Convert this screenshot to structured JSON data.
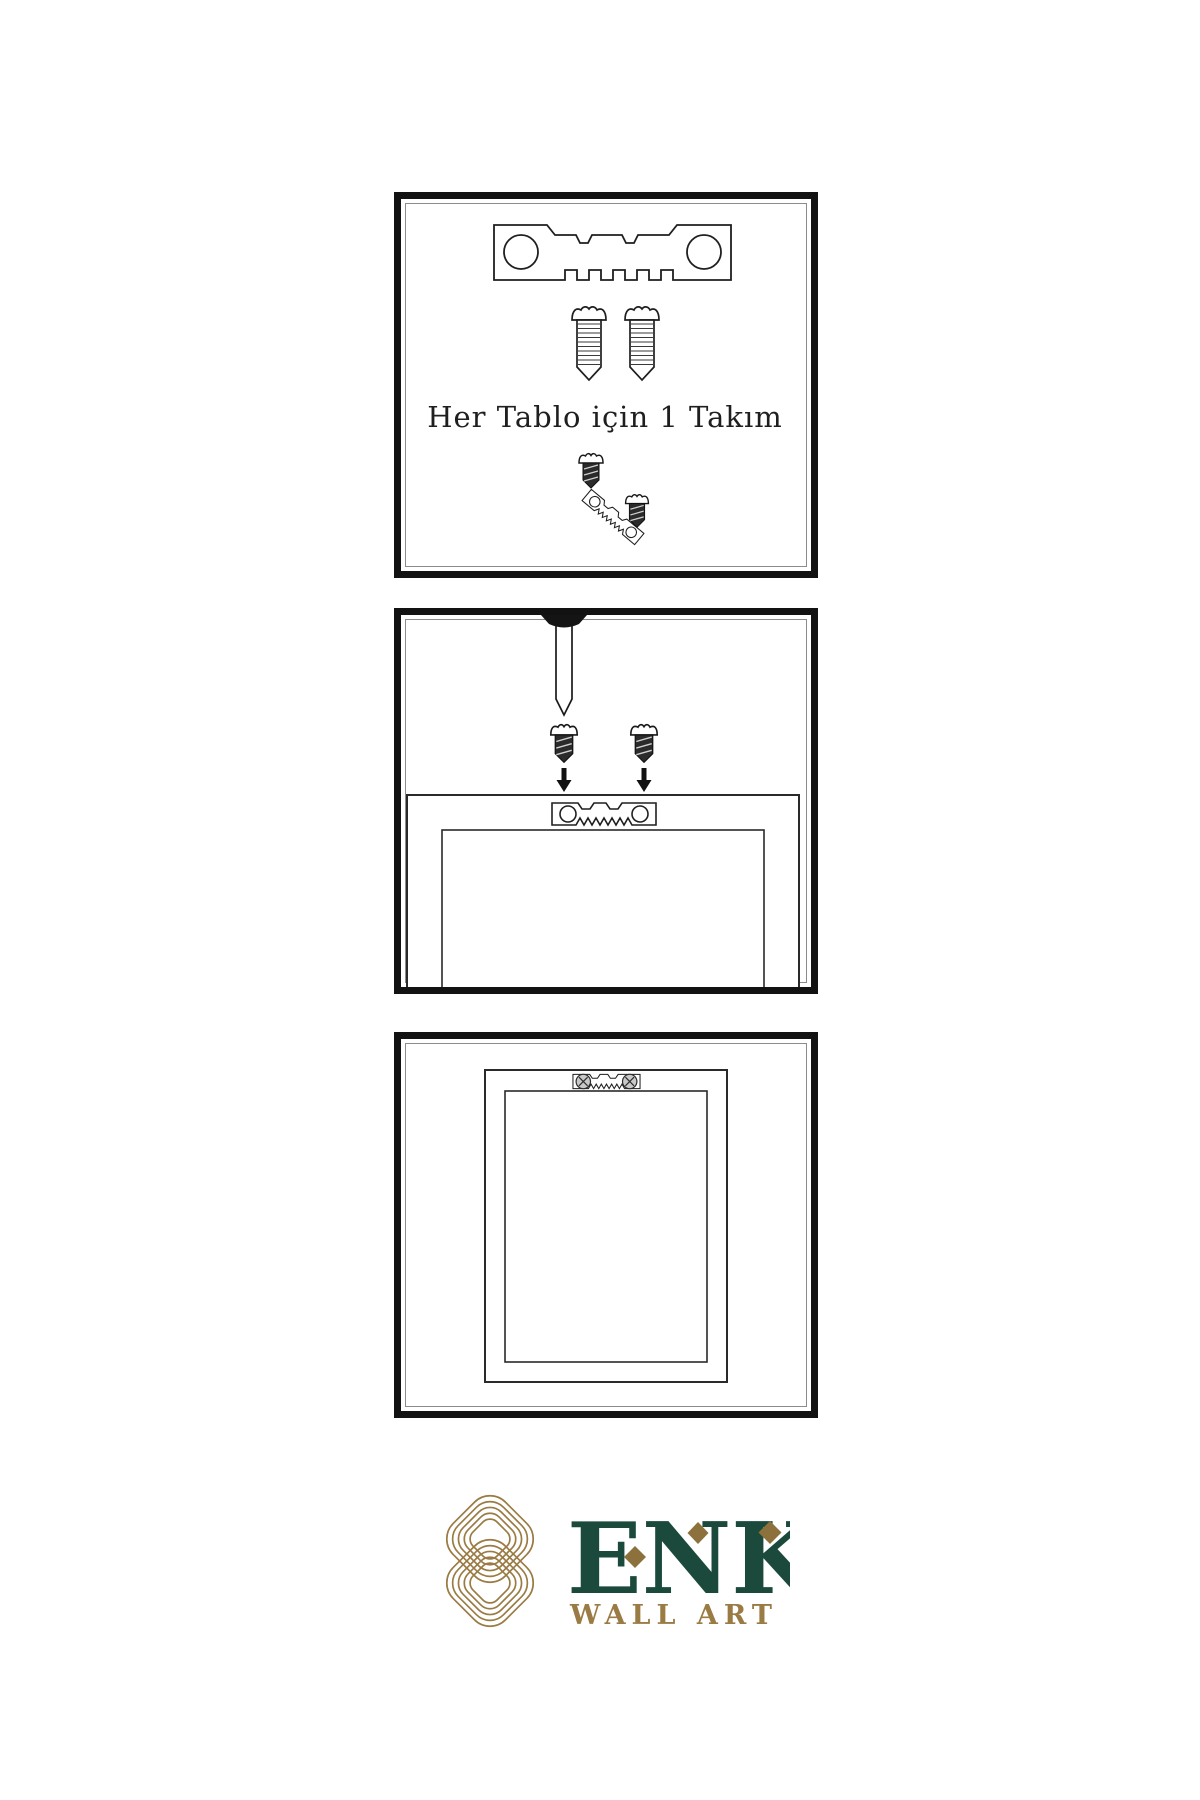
{
  "colors": {
    "background": "#ffffff",
    "panel_border": "#121212",
    "artwork_line": "#2a2a2a",
    "screw_dark_fill": "#2b2b2b",
    "brand_green": "#1b4a3c",
    "brand_gold": "#9a7b44",
    "brand_gold_dark": "#8d713c"
  },
  "step1": {
    "caption": "Her Tablo için 1 Takım"
  },
  "brand": {
    "name": "ENK",
    "subtitle": "WALL ART"
  },
  "illustrations": {
    "step1": [
      "sawtooth-hanger",
      "screw",
      "screw",
      "screw-dark",
      "angled-sawtooth-hanger",
      "screw-dark"
    ],
    "step2": [
      "wall-nail",
      "screw-dark",
      "screw-dark",
      "down-arrow",
      "down-arrow",
      "frame-back",
      "sawtooth-hanger-mounted"
    ],
    "step3": [
      "hung-frame",
      "sawtooth-hanger-with-screws"
    ],
    "logo": [
      "knot-monogram",
      "diamond",
      "diamond",
      "diamond"
    ]
  }
}
